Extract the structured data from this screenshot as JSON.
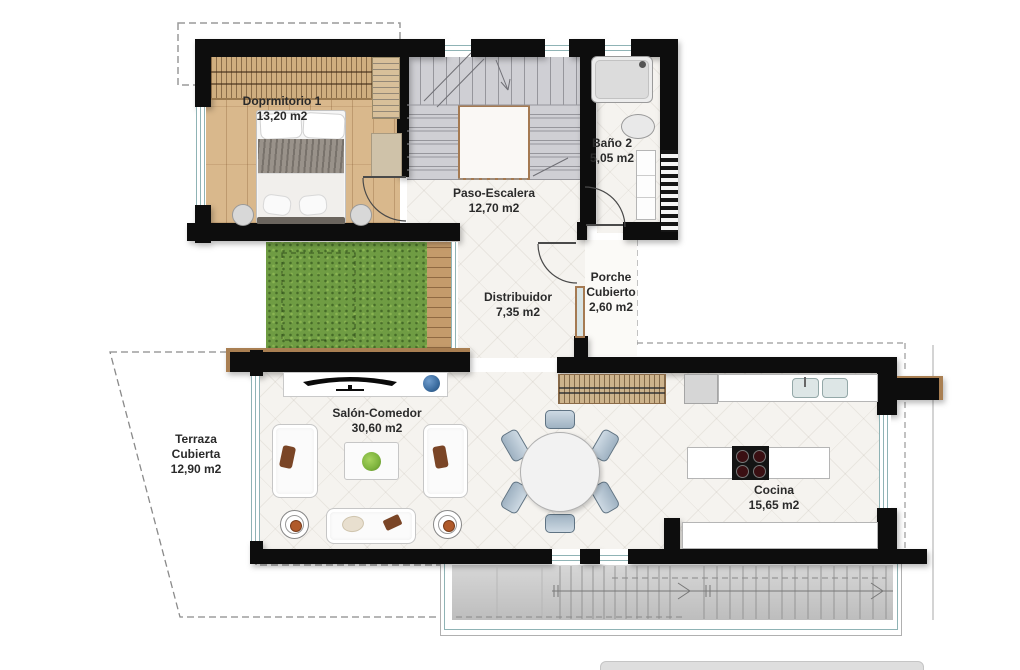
{
  "plan_type": "floor-plan",
  "rooms": {
    "dormitorio": {
      "line1": "Doprmitorio 1",
      "line2": "13,20 m2"
    },
    "paso": {
      "line1": "Paso-Escalera",
      "line2": "12,70 m2"
    },
    "bano": {
      "line1": "Baño 2",
      "line2": "5,05 m2"
    },
    "distribuidor": {
      "line1": "Distribuidor",
      "line2": "7,35 m2"
    },
    "porche": {
      "line1": "Porche",
      "line2": "Cubierto",
      "line3": "2,60 m2"
    },
    "salon": {
      "line1": "Salón-Comedor",
      "line2": "30,60 m2"
    },
    "cocina": {
      "line1": "Cocina",
      "line2": "15,65 m2"
    },
    "terraza": {
      "line1": "Terraza",
      "line2": "Cubierta",
      "line3": "12,90 m2"
    }
  },
  "furniture_icons": [
    "double-bed",
    "wardrobe",
    "shelving",
    "bathtub",
    "washbasin",
    "bathroom-cabinet",
    "staircase",
    "entrance-door",
    "interior-door",
    "tv-console",
    "tv",
    "vase",
    "sofa",
    "coffee-table",
    "plant",
    "side-table",
    "dining-table",
    "dining-chair",
    "pantry-wardrobe",
    "fridge",
    "kitchen-counter",
    "double-sink",
    "kitchen-island",
    "cooktop",
    "lawn",
    "wood-deck",
    "exterior-steps"
  ],
  "colors": {
    "wall": "#0d0d0d",
    "wood_floor": "#d9b88c",
    "deck_wood": "#c49b6b",
    "grass": "#6f9c43",
    "glazing": "#8fb3b5",
    "stairs": "#cfcfd4",
    "stair_void_border": "#a57a52",
    "label_text": "#2a2a2a",
    "vase_blue": "#3a6b9e",
    "plant_green": "#7cb23c",
    "cushion_brown": "#7a4526",
    "chair_blue": "#b9c9d6",
    "paving_grey": "#c9c9c9",
    "burner": "#3a0f12"
  }
}
